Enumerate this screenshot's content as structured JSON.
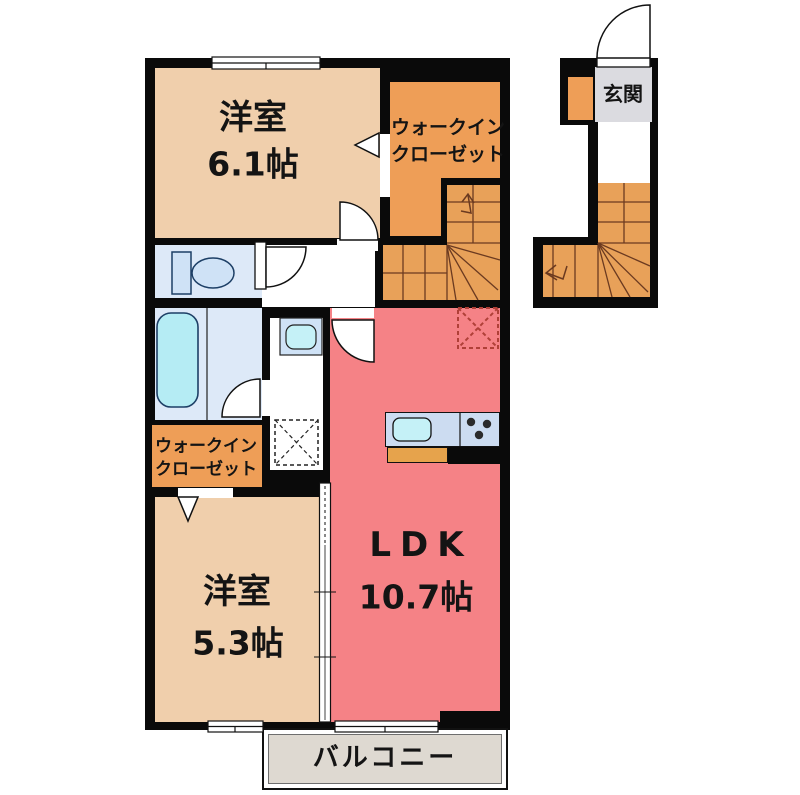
{
  "floorplan": {
    "rooms": {
      "bedroom1": {
        "name": "洋室",
        "size": "6.1帖"
      },
      "wic_upper": {
        "line1": "ウォークイン",
        "line2": "クローゼット"
      },
      "entrance": {
        "label": "玄関"
      },
      "wic_lower": {
        "line1": "ウォークイン",
        "line2": "クローゼット"
      },
      "bedroom2": {
        "name": "洋室",
        "size": "5.3帖"
      },
      "ldk": {
        "name": "LDK",
        "size": "10.7帖"
      },
      "balcony": {
        "label": "バルコニー"
      }
    },
    "colors": {
      "wall": "#0a0a0a",
      "bedroom_floor": "#f0cfac",
      "closet_floor": "#ee9e57",
      "stairs_floor": "#e8a159",
      "ldk_floor": "#f58286",
      "sanitary_floor": "#dde9f8",
      "water_fixture": "#b5ecf4",
      "kitchen_counter": "#ccdcf1",
      "counter_base": "#e6a34c",
      "entrance_floor": "#dbdbe0",
      "balcony_floor": "#ded9d1"
    }
  }
}
